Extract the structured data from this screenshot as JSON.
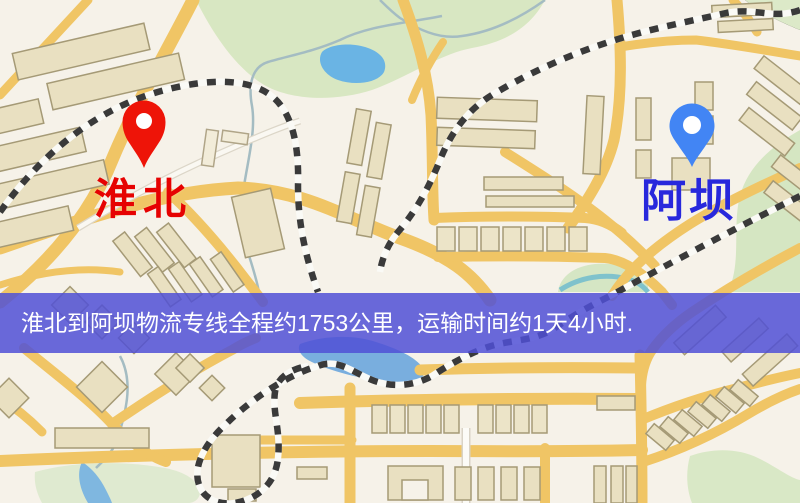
{
  "map": {
    "markers": {
      "origin": {
        "label": "淮北",
        "pin_color": "#ee1408",
        "label_color": "#e60202"
      },
      "destination": {
        "label": "阿坝",
        "pin_color": "#4285f4",
        "label_color": "#2828dc"
      }
    },
    "banner": {
      "text": "淮北到阿坝物流专线全程约1753公里，运输时间约1天4小时.",
      "distance_km": "1753",
      "duration": "1天4小时",
      "bg_color": "#5252d6",
      "text_color": "#ffffff"
    },
    "palette": {
      "background": "#f6f2e9",
      "road": "#f0c565",
      "building": "#e9e0c1",
      "water": "#6ab4e4",
      "park": "#d8e7c2",
      "railway": "#3a3a3a"
    }
  }
}
